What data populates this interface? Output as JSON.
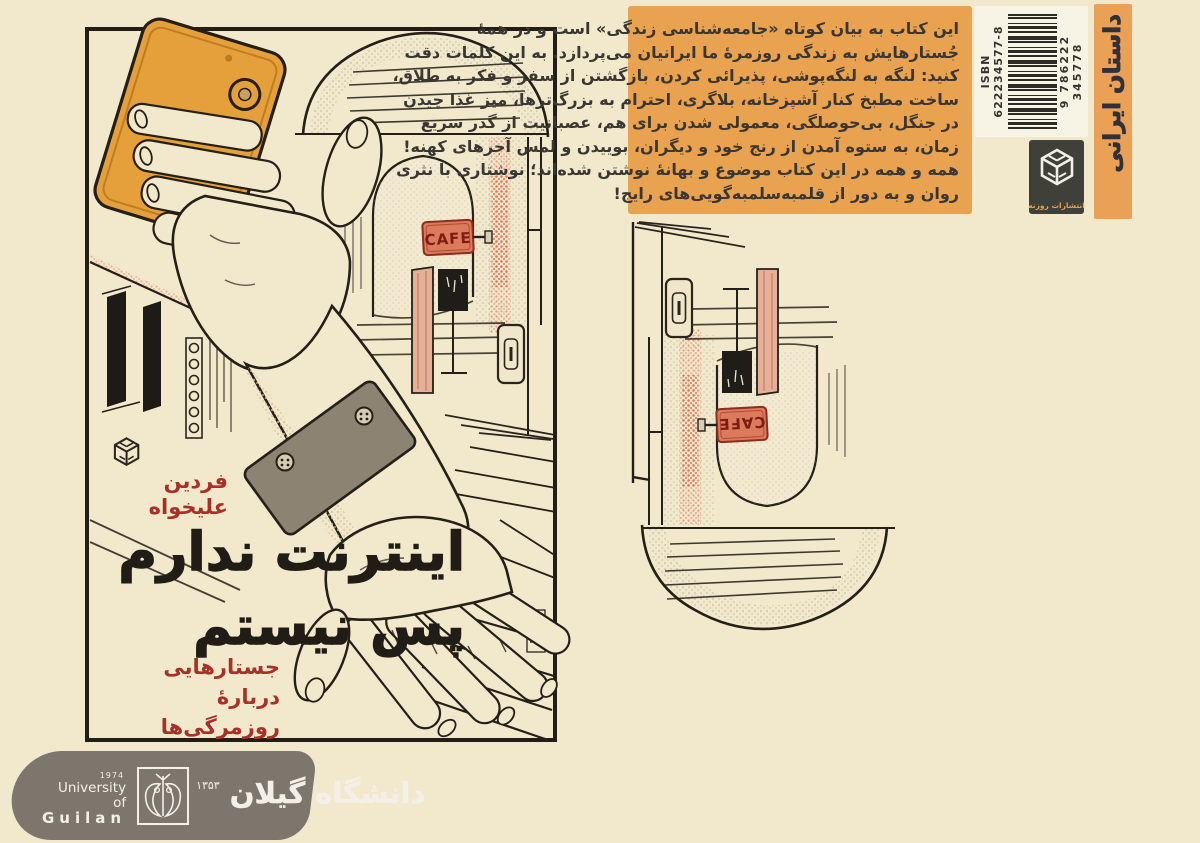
{
  "front_cover": {
    "author_line1": "فردین",
    "author_line2": "علیخواه",
    "title_line1": "اینترنت ندارم",
    "title_line2": "پس نیستم",
    "subtitle_line1": "جستارهایی",
    "subtitle_line2": "دربارهٔ روزمرگی‌ها",
    "cafe_sign": "CAFE"
  },
  "back_cover": {
    "synopsis_lines": [
      "این کتاب به بیان کوتاه «جامعه‌شناسی زندگی» است و در همهٔ",
      "جُستارهایش به زندگی روزمرهٔ ما ایرانیان می‌پردازد. به این کلمات دقت",
      "کنید: لنگه به لنگه‌پوشی، پذیرائی کردن، بازگشتن از سفر و فکر به طلاق،",
      "ساخت مطبخ کنار آشپزخانه، بلاگری، احترام به بزرگ‌ترها، میز غذا چیدن",
      "در جنگل، بی‌حوصلگی، معمولی شدن برای هم، عصبانیت از گذر سریع",
      "زمان، به ستوه آمدن از رنج خود و دیگران، بوییدن و لمس آجرهای کهنه!",
      "همه و همه در این کتاب موضوع و بهانهٔ نوشتن شده‌اند؛ نوشتاری با نثری",
      "روان و به دور از قلمبه‌سلمبه‌گویی‌های رایج!"
    ],
    "genre_label": "داستان ایرانی",
    "publisher_name": "انتشارات روزنه",
    "isbn_label": "ISBN 622234577-8",
    "barcode_number": "9 786222 345778"
  },
  "footer": {
    "university_en_line1": "University of",
    "university_en_line2": "Guilan",
    "established_year_en": "1974",
    "established_year_fa": "۱۳۵۳",
    "university_fa": "دانشگاه گیلان"
  },
  "colors": {
    "background": "#f2e9cc",
    "synopsis_orange": "#e9a24f",
    "genre_strip_orange": "#eba155",
    "cover_red": "#a93027",
    "title_black": "#211c16",
    "phone_orange": "#e5a03c",
    "cafe_sign_red": "#db7a5c",
    "wristband_taupe": "#8d8373",
    "banner_gray": "#7c766c",
    "publisher_badge_dark": "#3f403a",
    "ink": "#241f17"
  }
}
